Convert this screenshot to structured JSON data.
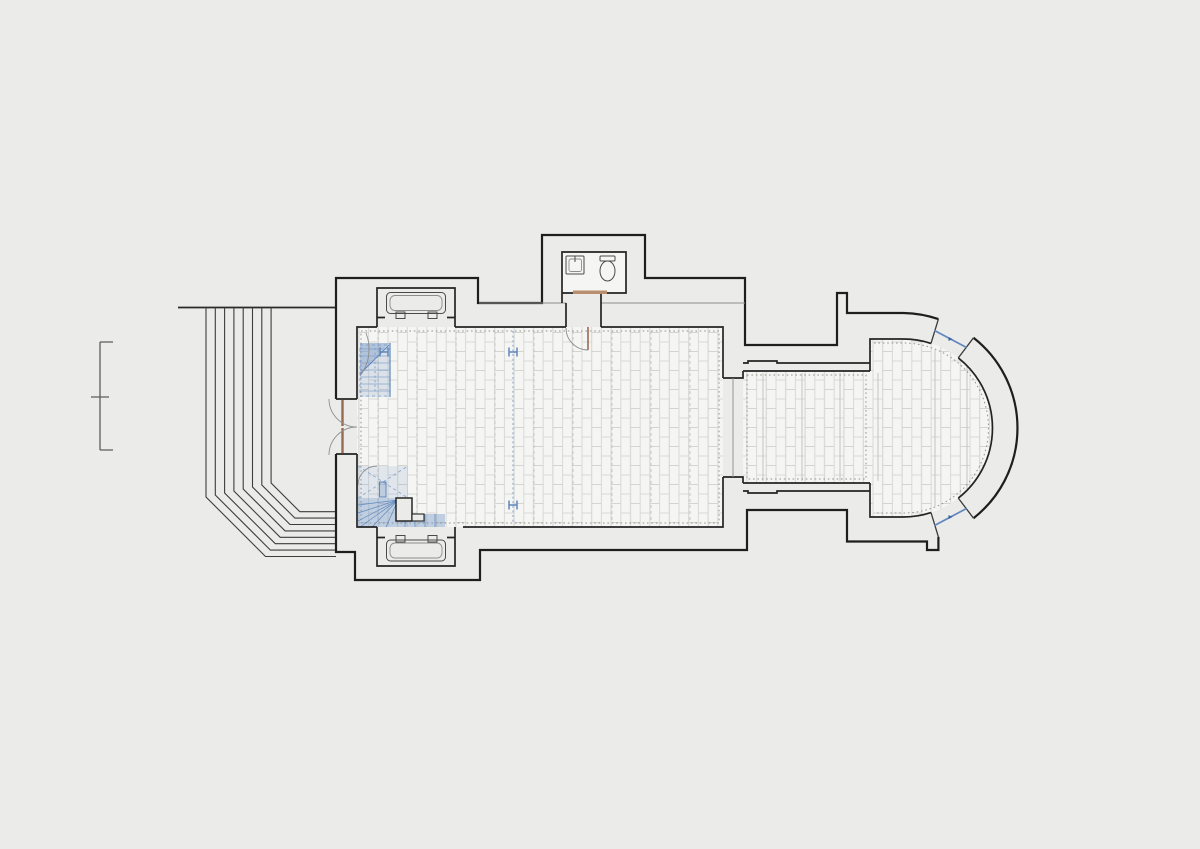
{
  "document": {
    "kind": "architectural floor plan",
    "subject": "small single-nave church with apse, entrance stair fan, WC annex and gallery stairs",
    "background_color": "#ebebe9",
    "visible_text": ""
  },
  "palette": {
    "wall": "#1e1e1e",
    "inner_wall": "#242424",
    "thin_line": "#8d8d8b",
    "floor_fill": "#f5f5f3",
    "floor_joint": "#d3d3d0",
    "dotted_line": "#94948e",
    "blue": "#5f87bd",
    "blue_tint": "rgba(110,147,195,0.20)",
    "blue_tint_dark": "rgba(110,147,195,0.40)",
    "door_wood": "#9a6a52",
    "threshold_wood": "#b98f6f"
  },
  "scale_bar": {
    "x": 100,
    "y_top": 342,
    "y_mid": 397,
    "y_bottom": 450,
    "tick_len": 13,
    "mid_tick_half": 9
  },
  "entrance_steps": {
    "count": 8,
    "x0": 206,
    "dx": 9.3,
    "top_y": 307.5,
    "bend_y0": 497,
    "bend_dy": -2,
    "bottom_y0": 556.5,
    "bottom_dy": -6.4,
    "end_x": 336,
    "landing_left_x": 178
  },
  "h_markers": [
    {
      "x": 513,
      "y": 352
    },
    {
      "x": 513,
      "y": 505
    },
    {
      "x": 384,
      "y": 352
    }
  ],
  "blue_center_line": {
    "x": 513,
    "y1": 331,
    "y2": 523
  },
  "apse_windows": [
    {
      "x1": 934.5,
      "y1": 330.5,
      "x2": 966.5,
      "y2": 347.5
    },
    {
      "x1": 966.5,
      "y1": 508.5,
      "x2": 934.5,
      "y2": 525.5
    }
  ],
  "beam_lines": {
    "nave": [
      {
        "x": 378,
        "y1": 331,
        "y2": 523
      },
      {
        "x": 417,
        "y1": 331,
        "y2": 523
      },
      {
        "x": 456,
        "y1": 331,
        "y2": 523
      },
      {
        "x": 495,
        "y1": 331,
        "y2": 523
      },
      {
        "x": 534,
        "y1": 331,
        "y2": 523
      },
      {
        "x": 573,
        "y1": 331,
        "y2": 523
      },
      {
        "x": 612,
        "y1": 331,
        "y2": 523
      },
      {
        "x": 651,
        "y1": 331,
        "y2": 523
      },
      {
        "x": 690,
        "y1": 331,
        "y2": 523
      }
    ],
    "chancel": [
      {
        "x": 763,
        "y1": 373,
        "y2": 481
      },
      {
        "x": 802,
        "y1": 373,
        "y2": 481
      },
      {
        "x": 840,
        "y1": 373,
        "y2": 481
      },
      {
        "x": 878,
        "y1": 373,
        "y2": 481
      }
    ],
    "apse": [
      {
        "x": 935,
        "y1": 350,
        "y2": 506
      },
      {
        "x": 967,
        "y1": 367,
        "y2": 489
      }
    ]
  },
  "rooms": [
    {
      "name": "nave"
    },
    {
      "name": "chancel"
    },
    {
      "name": "apse"
    },
    {
      "name": "wc-annex"
    },
    {
      "name": "north-gallery-stair"
    },
    {
      "name": "south-winder-stair"
    }
  ],
  "fixtures": [
    {
      "name": "sink"
    },
    {
      "name": "toilet"
    },
    {
      "name": "radiator-north-niche"
    },
    {
      "name": "radiator-south-niche"
    },
    {
      "name": "west-double-door"
    },
    {
      "name": "vestibule-door"
    }
  ]
}
